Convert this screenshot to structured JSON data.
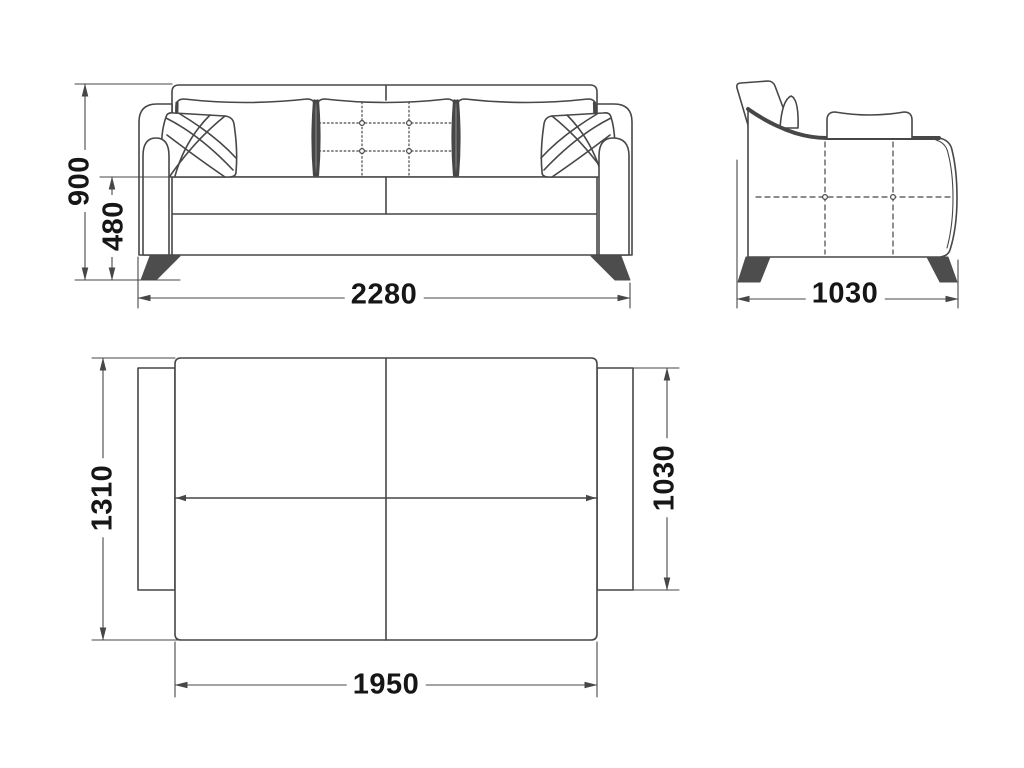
{
  "diagram": {
    "subject": "sofa-bed technical dimension drawing, three orthographic views",
    "views": {
      "front": {
        "label": "front-view",
        "dimensions": {
          "overall_height": {
            "value": "900",
            "orientation": "vertical"
          },
          "seat_height": {
            "value": "480",
            "orientation": "vertical"
          },
          "overall_width": {
            "value": "2280",
            "orientation": "horizontal"
          }
        }
      },
      "side": {
        "label": "side-view",
        "dimensions": {
          "overall_depth": {
            "value": "1030",
            "orientation": "horizontal"
          }
        }
      },
      "plan": {
        "label": "plan-view-unfolded-bed",
        "dimensions": {
          "bed_width": {
            "value": "1310",
            "orientation": "vertical"
          },
          "bed_length": {
            "value": "1950",
            "orientation": "horizontal"
          },
          "seat_depth": {
            "value": "1030",
            "orientation": "vertical"
          }
        }
      }
    },
    "colors": {
      "line": "#474747",
      "leg_fill": "#4d4d4d",
      "text": "#161616",
      "background": "#ffffff"
    }
  }
}
